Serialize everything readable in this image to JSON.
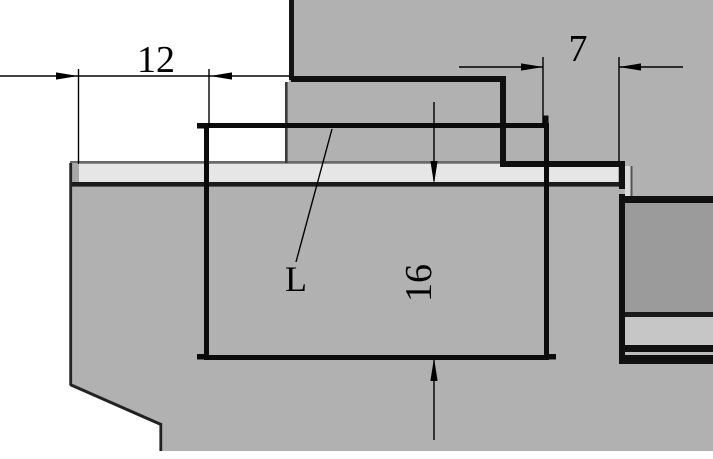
{
  "drawing": {
    "type": "technical-cross-section",
    "dimensions": {
      "width_left": {
        "label": "12",
        "orientation": "horizontal"
      },
      "width_right": {
        "label": "7",
        "orientation": "horizontal"
      },
      "height": {
        "label": "16",
        "orientation": "vertical"
      },
      "leader": {
        "label": "L"
      }
    },
    "colors": {
      "background": "#ffffff",
      "body_gray": "#b1b1b1",
      "strip_light": "#e6e6e6",
      "block_dark": "#9b9b9b",
      "band_light": "#c6c6c6",
      "line_black": "#101010"
    }
  }
}
